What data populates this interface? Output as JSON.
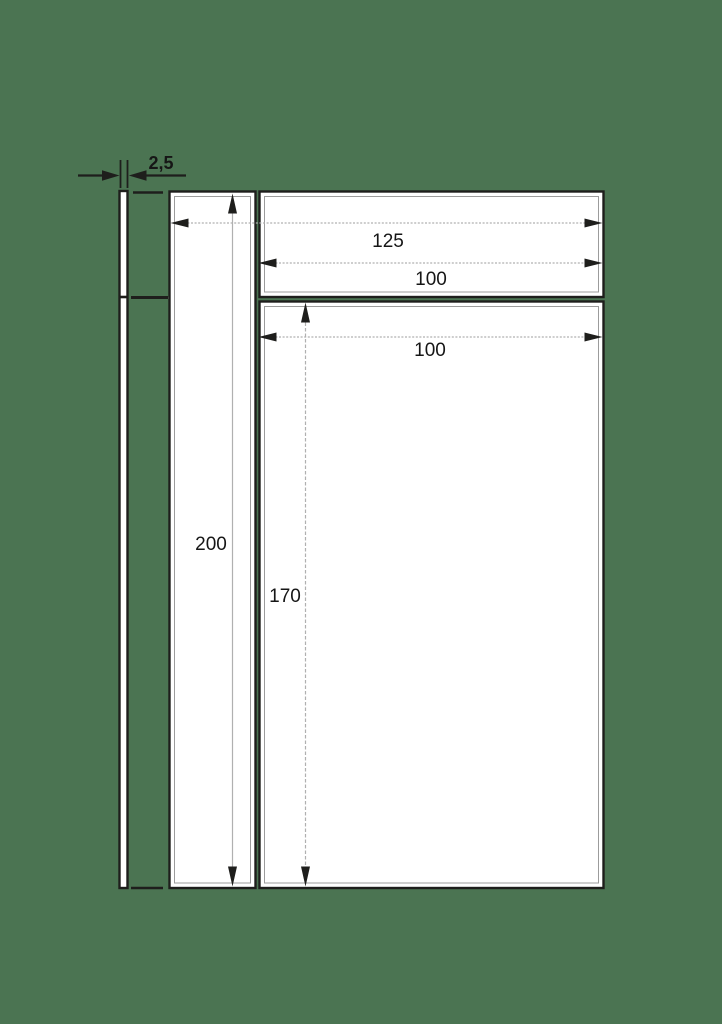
{
  "drawing": {
    "labels": {
      "thickness": "2,5",
      "total_width": "125",
      "top_section_width": "100",
      "main_section_width": "100",
      "total_height": "200",
      "main_section_height": "170"
    },
    "dimensions": [
      {
        "name": "panel-thickness",
        "label": "2,5"
      },
      {
        "name": "overall-width",
        "label": "125"
      },
      {
        "name": "top-section-width",
        "label": "100"
      },
      {
        "name": "main-section-width",
        "label": "100"
      },
      {
        "name": "overall-height",
        "label": "200"
      },
      {
        "name": "main-section-height",
        "label": "170"
      }
    ],
    "colors": {
      "background": "#4b7452",
      "linework": "#1e1e1c",
      "dimension_line": "#b0b0b0",
      "inner_line": "#9c9c9c",
      "panel_fill": "#ffffff"
    }
  }
}
